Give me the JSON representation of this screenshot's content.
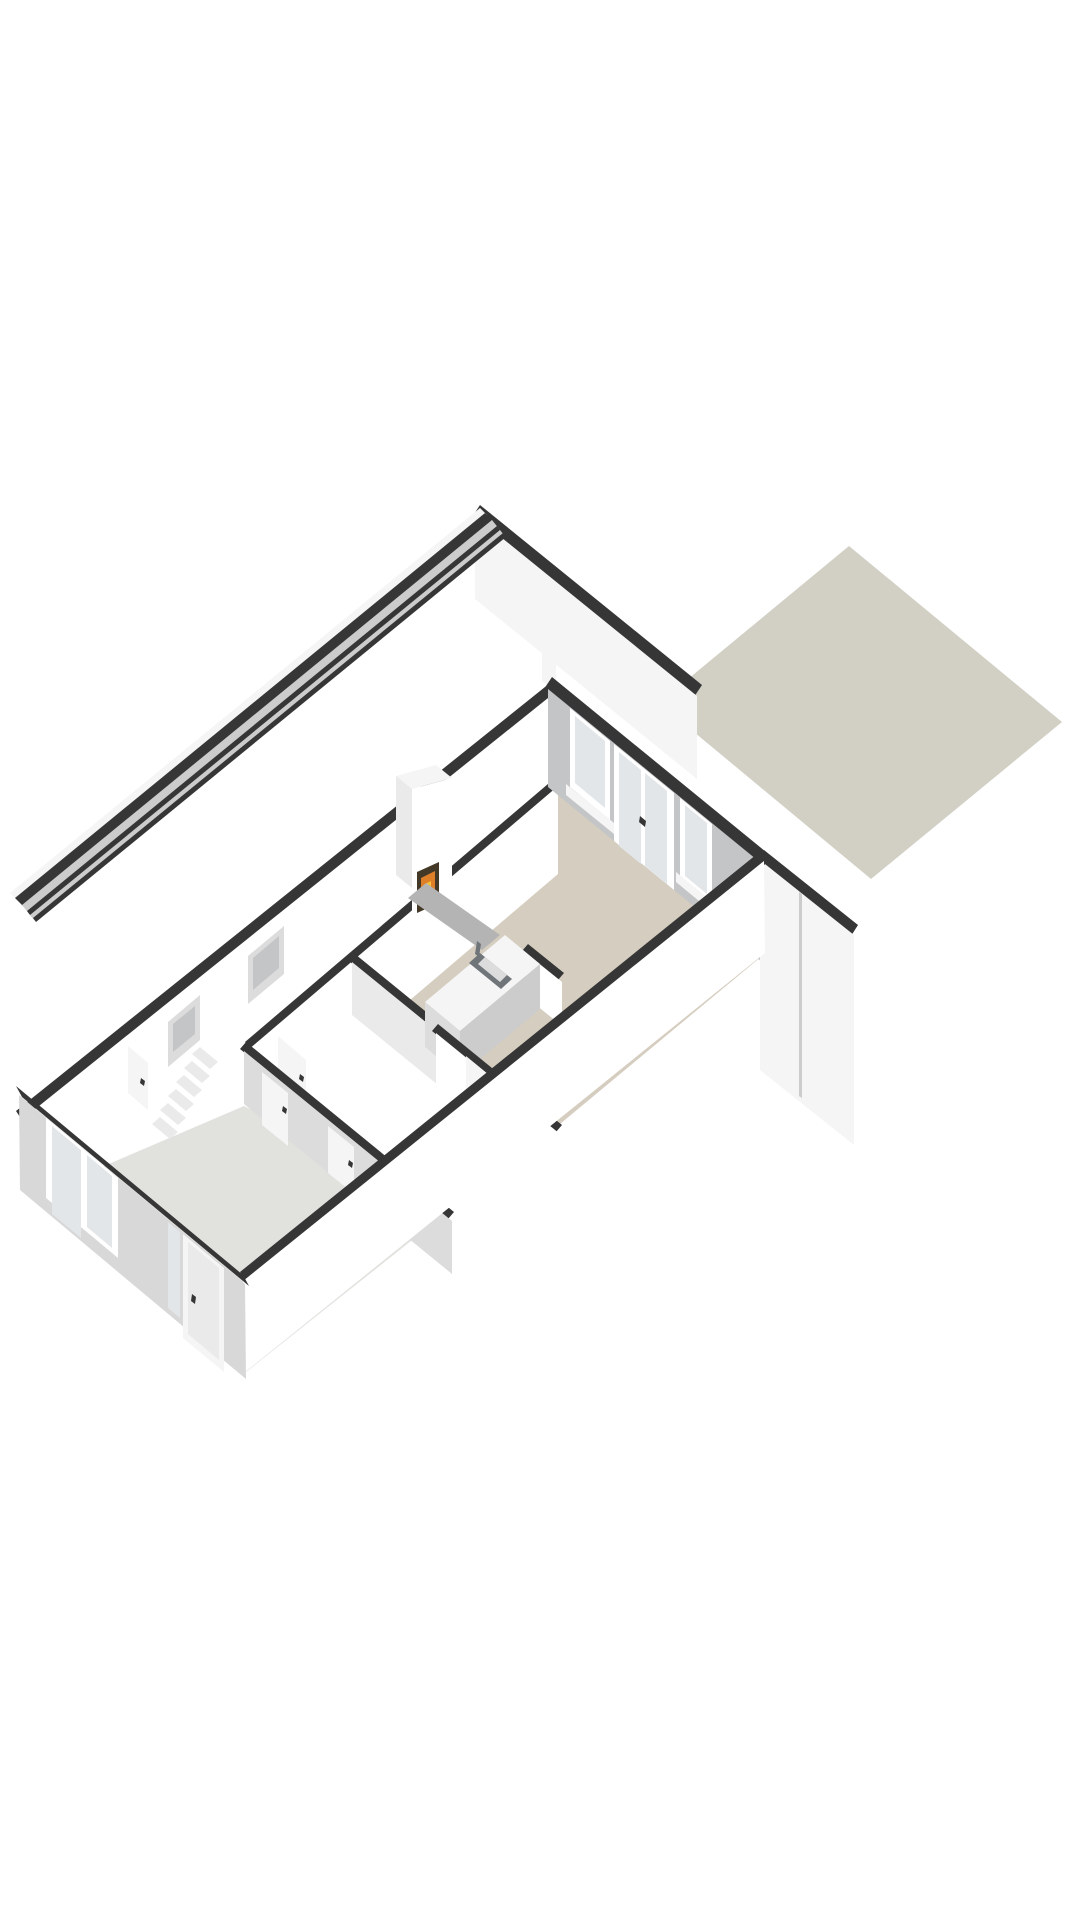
{
  "meta": {
    "title": "3D floor plan render - ground floor (isometric view)",
    "type": "3d-floorplan",
    "background": "#ffffff",
    "canvas": {
      "width": 1080,
      "height": 1920
    }
  },
  "palette": {
    "dark": "#363636",
    "white": "#ffffff",
    "white2": "#f5f5f5",
    "white3": "#eaeaea",
    "grey1": "#dcdcdc",
    "grey2": "#cccccc",
    "grey3": "#c3c5c7",
    "pane": "#e3e6e8",
    "beige": "#d5cdbf",
    "hall": "#e1e1de",
    "terrace": "#d2d0c5",
    "swface": "#d8d8d8",
    "hearth": "#b4b4b4",
    "metal": "#70757a",
    "fire1": "#df7f28",
    "fire2": "#f4c33b",
    "firedark": "#443827"
  },
  "objects": [
    {
      "name": "terrace-slab",
      "description": "grey-beige garden terrace behind the house"
    },
    {
      "name": "living-room",
      "description": "open living room / kitchen with beige floor"
    },
    {
      "name": "fireplace",
      "description": "white chimney breast with lit wood fire and grey hearth"
    },
    {
      "name": "kitchen-island",
      "description": "white kitchen island with inset sink and faucet"
    },
    {
      "name": "garden-wall-glazing",
      "description": "rear wall with window, double french doors and second window"
    },
    {
      "name": "hallway",
      "description": "entrance hall with grey floor, staircase and interior doors"
    },
    {
      "name": "staircase",
      "description": "six visible treads rising toward the living level"
    },
    {
      "name": "front-door",
      "description": "front entrance door with narrow sidelight window"
    },
    {
      "name": "front-window",
      "description": "large two-pane window on the street facade"
    }
  ],
  "scene": {
    "polygons": [
      {
        "n": "terrace-slab",
        "f": "terrace",
        "p": "849,546 1062,722 871,879 659,703"
      },
      {
        "n": "back-party-wall-top",
        "f": "dark",
        "p": "480,505 702,685 694,697 472,517"
      },
      {
        "n": "back-party-wall-face",
        "f": "white2",
        "p": "475,516 697,696 697,779 475,599"
      },
      {
        "n": "nw-party-wall-cap",
        "f": "white2",
        "p": "10,893 480,508 487,515 17,900"
      },
      {
        "n": "nw-party-wall-top",
        "f": "dark",
        "p": "15,898 485,513 493,521 23,906"
      },
      {
        "n": "side-passage-strip",
        "f": "grey2",
        "p": "22,905 492,520 504,535 34,920"
      },
      {
        "n": "passage-line-a",
        "f": "dark",
        "p": "27,911 497,526 500,530 30,915"
      },
      {
        "n": "passage-line-b",
        "f": "dark",
        "p": "33,918 503,533 506,537 36,922"
      },
      {
        "n": "nw-facade-top",
        "f": "dark",
        "p": "555,679 16,1111 22,1120 561,688"
      },
      {
        "n": "nw-facade-inner-face",
        "f": "white",
        "p": "558,690 19,1122 19,1182 558,750"
      },
      {
        "n": "nw-window-1-frame",
        "f": "grey1",
        "p": "248,956 284,926 284,974 248,1004"
      },
      {
        "n": "nw-window-1-pane",
        "f": "grey3",
        "p": "253,958 279,936 279,968 253,990"
      },
      {
        "n": "nw-window-2-frame",
        "f": "grey1",
        "p": "168,1022 200,995 200,1040 168,1067"
      },
      {
        "n": "nw-window-2-pane",
        "f": "grey3",
        "p": "173,1024 195,1006 195,1034 173,1052"
      },
      {
        "n": "back-corner-cap",
        "f": "white2",
        "p": "542,620 556,631 556,692 542,681"
      },
      {
        "n": "living-room-floor",
        "f": "beige",
        "p": "562,786 762,956 560,1124 438,1024 355,952"
      },
      {
        "n": "spine-wall-top",
        "f": "dark",
        "p": "555,778 245,1042 251,1049 561,785"
      },
      {
        "n": "spine-wall-face",
        "f": "white",
        "p": "558,786 248,1050 248,1138 558,874"
      },
      {
        "n": "interior-door-1",
        "f": "white2",
        "p": "278,1036 306,1060 306,1112 278,1088"
      },
      {
        "n": "interior-door-1-handle",
        "f": "dark",
        "p": "300,1074 304,1077 303,1082 299,1079"
      },
      {
        "n": "m2-wall-top",
        "f": "dark",
        "p": "355,954 441,1024 435,1031 349,961"
      },
      {
        "n": "m2-wall-face",
        "f": "white3",
        "p": "352,962 438,1032 438,1085 352,1015"
      },
      {
        "n": "chimney-cap",
        "f": "white2",
        "p": "396,776 412,789 452,778 436,765"
      },
      {
        "n": "chimney-side",
        "f": "white3",
        "p": "396,776 412,789 412,888 396,875"
      },
      {
        "n": "chimney-front",
        "f": "white",
        "p": "412,789 452,778 452,900 412,911"
      },
      {
        "n": "firebox",
        "f": "firedark",
        "p": "417,872 439,862 439,903 417,913"
      },
      {
        "n": "fire-glow",
        "f": "fire1",
        "p": "421,878 435,871 435,898 421,905"
      },
      {
        "n": "fire-flame",
        "f": "fire2",
        "p": "425,884 431,881 431,894 425,897"
      },
      {
        "n": "hearth-slab",
        "f": "hearth",
        "p": "408,898 482,950 500,935 426,883"
      },
      {
        "n": "pantry-wall-top",
        "f": "dark",
        "p": "522,951 558,980 564,973 528,944"
      },
      {
        "n": "pantry-wall-face",
        "f": "white",
        "p": "526,953 562,982 562,1026 526,997"
      },
      {
        "n": "island-top",
        "f": "white2",
        "p": "505,935 540,964 460,1031 425,1002"
      },
      {
        "n": "island-face-sw",
        "f": "grey1",
        "p": "425,1002 460,1031 460,1076 425,1047"
      },
      {
        "n": "island-face-se",
        "f": "grey2",
        "p": "460,1031 540,964 540,1009 460,1076"
      },
      {
        "n": "sink-rim",
        "f": "metal",
        "p": "480,953 512,979 501,989 469,963"
      },
      {
        "n": "sink-basin",
        "f": "grey1",
        "p": "485,957 507,975 500,982 478,964"
      },
      {
        "n": "faucet",
        "f": "metal",
        "p": "477,941 481,944 479,957 475,954"
      },
      {
        "n": "m3-wall-top",
        "f": "dark",
        "p": "438,1024 562,1125 556,1132 432,1031"
      },
      {
        "n": "m3-wall-face",
        "f": "white",
        "p": "436,1033 560,1134 560,1187 436,1086"
      },
      {
        "n": "interior-door-2",
        "f": "white2",
        "p": "466,1056 494,1079 494,1132 466,1109"
      },
      {
        "n": "interior-door-2-handle",
        "f": "dark",
        "p": "488,1096 492,1099 491,1104 487,1101"
      },
      {
        "n": "hall-floor",
        "f": "hall",
        "p": "244,1106 450,1210 246,1372 62,1184"
      },
      {
        "n": "stair-tread-1",
        "f": "white3",
        "p": "152,1124 170,1139 178,1132 160,1117"
      },
      {
        "n": "stair-riser-1",
        "f": "white",
        "p": "160,1117 178,1132 178,1125 160,1110"
      },
      {
        "n": "stair-tread-2",
        "f": "white3",
        "p": "160,1110 178,1125 186,1118 168,1103"
      },
      {
        "n": "stair-riser-2",
        "f": "white",
        "p": "168,1103 186,1118 186,1111 168,1096"
      },
      {
        "n": "stair-tread-3",
        "f": "white3",
        "p": "168,1096 186,1111 194,1104 176,1089"
      },
      {
        "n": "stair-riser-3",
        "f": "white",
        "p": "176,1089 194,1104 194,1097 176,1082"
      },
      {
        "n": "stair-tread-4",
        "f": "white3",
        "p": "176,1082 194,1097 202,1090 184,1075"
      },
      {
        "n": "stair-riser-4",
        "f": "white",
        "p": "184,1075 202,1090 202,1083 184,1068"
      },
      {
        "n": "stair-tread-5",
        "f": "white3",
        "p": "184,1068 202,1083 210,1076 192,1061"
      },
      {
        "n": "stair-riser-5",
        "f": "white",
        "p": "192,1061 210,1076 210,1069 192,1054"
      },
      {
        "n": "stair-tread-6",
        "f": "white3",
        "p": "192,1054 210,1069 218,1062 200,1047"
      },
      {
        "n": "stair-riser-6",
        "f": "white",
        "p": "200,1047 218,1062 218,1055 200,1040"
      },
      {
        "n": "interior-door-3",
        "f": "white2",
        "p": "128,1046 148,1063 148,1110 128,1093"
      },
      {
        "n": "interior-door-3-handle",
        "f": "dark",
        "p": "141,1078 145,1081 144,1086 140,1083"
      },
      {
        "n": "hall-wall-top",
        "f": "dark",
        "p": "246,1042 454,1212 448,1219 240,1049"
      },
      {
        "n": "hall-wall-face",
        "f": "grey1",
        "p": "244,1051 452,1221 452,1274 244,1104"
      },
      {
        "n": "interior-door-4",
        "f": "white2",
        "p": "262,1072 288,1093 288,1146 262,1125"
      },
      {
        "n": "interior-door-4-handle",
        "f": "dark",
        "p": "283,1106 287,1109 286,1114 282,1111"
      },
      {
        "n": "interior-door-5",
        "f": "white2",
        "p": "328,1126 354,1147 354,1194 328,1173"
      },
      {
        "n": "interior-door-5-handle",
        "f": "dark",
        "p": "349,1160 353,1163 352,1168 348,1165"
      },
      {
        "n": "garden-wall-top",
        "f": "dark",
        "p": "552,677 766,852 758,864 544,689"
      },
      {
        "n": "garden-wall-face",
        "f": "grey3",
        "p": "548,689 762,864 762,962 548,787"
      },
      {
        "n": "garden-window-1-frame",
        "f": "white",
        "p": "570,708 610,741 610,820 570,787"
      },
      {
        "n": "garden-window-1-pane",
        "f": "pane",
        "p": "575,716 605,741 605,808 575,783"
      },
      {
        "n": "french-doors-frame",
        "f": "white",
        "p": "614,744 674,793 674,890 614,841"
      },
      {
        "n": "french-door-1-pane",
        "f": "pane",
        "p": "619,752 641,770 641,864 619,846"
      },
      {
        "n": "french-door-2-pane",
        "f": "pane",
        "p": "645,773 667,791 667,884 645,866"
      },
      {
        "n": "french-door-handles",
        "f": "dark",
        "p": "640,816 646,821 645,827 639,822"
      },
      {
        "n": "garden-window-2-frame",
        "f": "white",
        "p": "680,798 712,824 712,902 680,876"
      },
      {
        "n": "garden-window-2-pane",
        "f": "pane",
        "p": "685,805 707,823 707,894 685,876"
      },
      {
        "n": "window-sill-1",
        "f": "white2",
        "p": "566,784 614,823 614,834 566,795"
      },
      {
        "n": "window-sill-2",
        "f": "white2",
        "p": "676,872 716,905 716,915 676,882"
      },
      {
        "n": "se-party-wall-top",
        "f": "dark",
        "p": "764,850 858,925 851,936 757,861"
      },
      {
        "n": "se-party-wall-face",
        "f": "white2",
        "p": "760,860 854,935 854,1145 760,1070"
      },
      {
        "n": "se-party-wall-joint",
        "f": "grey2",
        "p": "799,892 802,894 802,1098 799,1096"
      },
      {
        "n": "se-facade-top",
        "f": "dark",
        "p": "762,850 240,1272 247,1283 769,861"
      },
      {
        "n": "se-facade-face",
        "f": "white",
        "p": "764,861 243,1281 244,1373 765,953"
      },
      {
        "n": "sw-facade-top",
        "f": "dark",
        "p": "16,1086 243,1275 249,1286 22,1097"
      },
      {
        "n": "sw-facade-face",
        "f": "swface",
        "p": "19,1095 245,1284 246,1379 20,1190"
      },
      {
        "n": "front-window-frame",
        "f": "white",
        "p": "46,1118 118,1178 118,1258 46,1198"
      },
      {
        "n": "front-window-pane-1",
        "f": "pane",
        "p": "52,1126 81,1150 81,1238 52,1214"
      },
      {
        "n": "front-window-pane-2",
        "f": "pane",
        "p": "87,1155 112,1176 112,1248 87,1227"
      },
      {
        "n": "front-door-frame",
        "f": "white2",
        "p": "183,1234 224,1268 224,1372 183,1338"
      },
      {
        "n": "front-door-leaf",
        "f": "white3",
        "p": "188,1242 219,1268 219,1360 188,1334"
      },
      {
        "n": "front-door-handle",
        "f": "dark",
        "p": "192,1294 196,1297 195,1304 191,1301"
      },
      {
        "n": "front-door-sidelight",
        "f": "pane",
        "p": "168,1222 180,1232 180,1318 168,1308"
      }
    ]
  }
}
